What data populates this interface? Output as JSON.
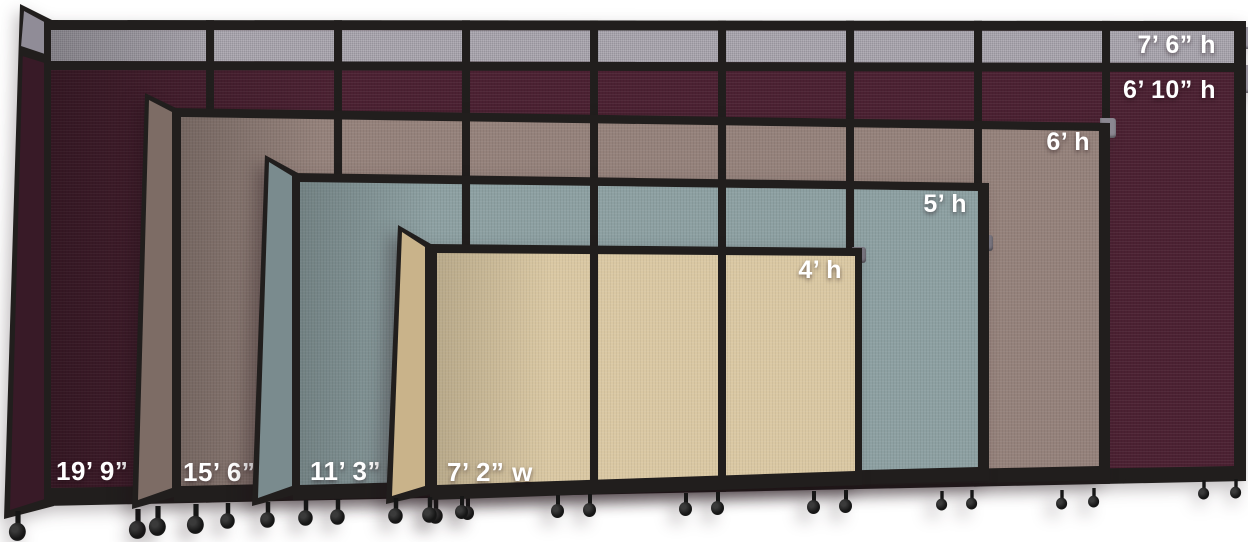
{
  "walls": [
    {
      "name": "divider-19ft9-burgundy",
      "width_label": "19’ 9” w",
      "height_label": "6’ 10” h",
      "top_extension_height_label": "7’ 6” h",
      "fabric_color": "#4b2132",
      "end_panel_color": "#381a27",
      "top_band_color": "#a6a2ab",
      "top_band_end_color": "#908c97"
    },
    {
      "name": "divider-15ft6-brown",
      "width_label": "15’ 6” w",
      "height_label": "6’ h",
      "fabric_color": "#95827b",
      "end_panel_color": "#7d6c65"
    },
    {
      "name": "divider-11ft3-slate",
      "width_label": "11’ 3” w",
      "height_label": "5’ h",
      "fabric_color": "#8da0a2",
      "end_panel_color": "#7a8b8e"
    },
    {
      "name": "divider-7ft2-beige",
      "width_label": "7’ 2” w",
      "height_label": "4’ h",
      "fabric_color": "#dac8a3",
      "end_panel_color": "#c9b38a"
    }
  ],
  "colors": {
    "frame": "#211e1d",
    "caster": "#161616",
    "background": "#ffffff",
    "label_text": "#ffffff",
    "bracket": "#9a96a1"
  }
}
